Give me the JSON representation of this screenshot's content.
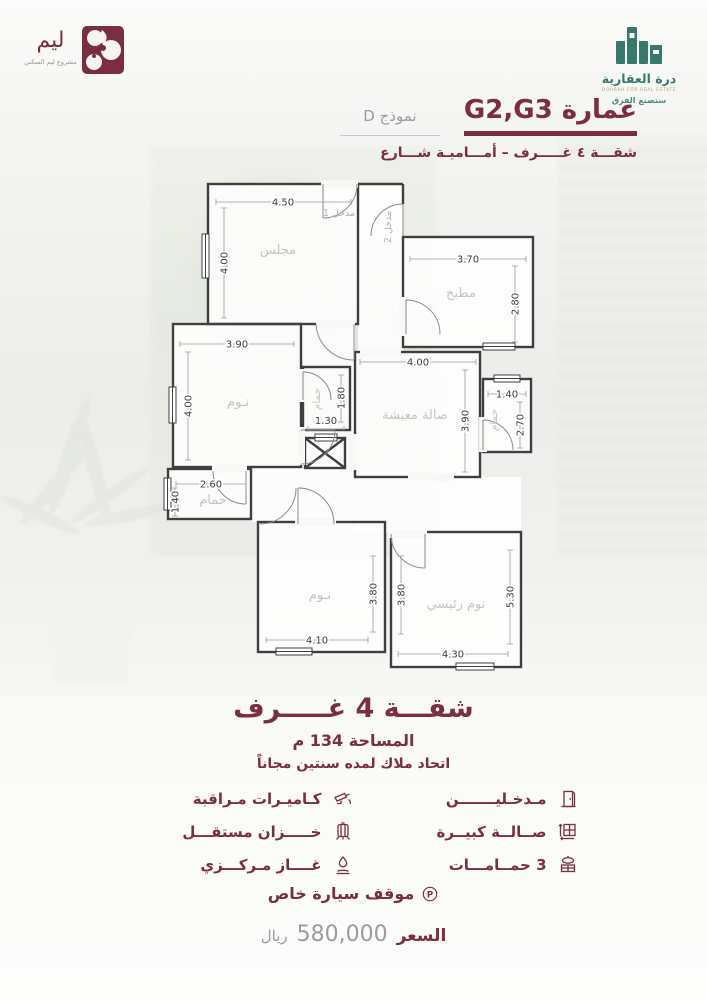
{
  "brand_left": {
    "name": "ليم",
    "tagline": "مشروع ليم السكني"
  },
  "brand_right": {
    "name": "درة العقارية",
    "subtext": "DORRAH FOR REAL ESTATE",
    "slogan": "سنصنع الفرق"
  },
  "header": {
    "building": "عمارة G2,G3",
    "model": "نموذج D",
    "subtitle": "شقـــة ٤ غـــــرف – أمـــاميـة شـــارع"
  },
  "plan": {
    "entrance1": "مدخل 1",
    "entrance2": "مدخل 2",
    "majlis": {
      "name": "مجلس",
      "w": "4.50",
      "h": "4.00"
    },
    "kitchen": {
      "name": "مطبخ",
      "w": "3.70",
      "h": "2.80"
    },
    "bedroom1": {
      "name": "نـوم",
      "w": "3.90",
      "h": "4.00"
    },
    "midbath": {
      "name": "حمام",
      "w": "1.30",
      "h": "1.80"
    },
    "living": {
      "name": "صالة معيشة",
      "w": "4.00",
      "h": "3.90"
    },
    "rightbath": {
      "name": "حمام",
      "w": "1.40",
      "h": "2.70"
    },
    "leftbath": {
      "name": "حمام",
      "w": "2.60",
      "h": "1.40"
    },
    "bedroom2": {
      "name": "نـوم",
      "w": "4.10",
      "h": "3.80"
    },
    "master": {
      "name": "نوم رئيسي",
      "w": "4.30",
      "h1": "3.80",
      "h2": "5.30"
    }
  },
  "summary": {
    "title": "شقـــة 4 غـــــرف",
    "area": "المساحة 134 م",
    "note": "اتحاد ملاك لمده سنتين مجاناً"
  },
  "features": [
    {
      "icon": "door-icon",
      "label": "مـدخـليـــــــن"
    },
    {
      "icon": "cctv-icon",
      "label": "كـاميـرات مـراقبة"
    },
    {
      "icon": "hall-icon",
      "label": "صــالــة كبيــرة"
    },
    {
      "icon": "tank-icon",
      "label": "خـــــزان مستقـــل"
    },
    {
      "icon": "sink-icon",
      "label": "3 حمــامـــات"
    },
    {
      "icon": "gas-icon",
      "label": "غــــاز مـركـــزي"
    }
  ],
  "parking": {
    "label": "موقف سيارة خاص"
  },
  "price": {
    "label": "السعر",
    "value": "580,000",
    "currency": "ريال"
  },
  "colors": {
    "maroon": "#7b2e40",
    "green": "#37796c",
    "text_gray": "#9b9ba1",
    "wall": "#3f3f3f"
  }
}
